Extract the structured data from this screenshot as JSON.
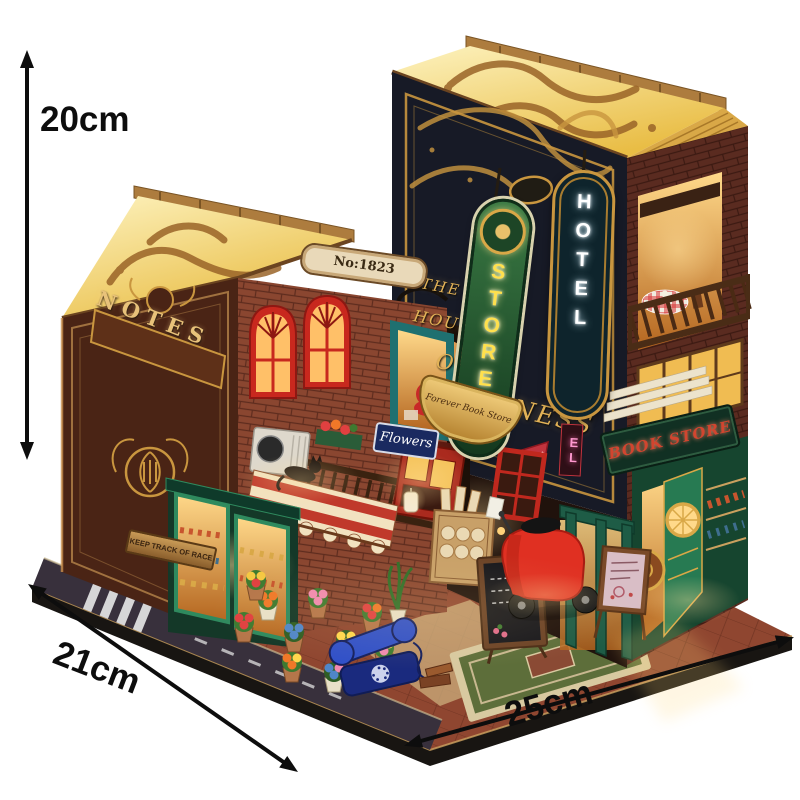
{
  "scene": {
    "subject": "DIY miniature book nook dollhouse product photo",
    "background": "#ffffff"
  },
  "dimensions": {
    "height": "20cm",
    "depth": "21cm",
    "width": "25cm",
    "arrow_color": "#0d0d0d"
  },
  "left_book": {
    "spine_title": "NOTES",
    "address_plaque": "No:1823",
    "flower_shop_sign": "Flowers",
    "hanging_board": "KEEP TRACK OF RACE"
  },
  "right_book": {
    "cover_title_line1": "THE",
    "cover_title_line2": "HOUSE",
    "cover_title_line3": "OF",
    "cover_title_line4": "HAPPINESS",
    "neon_store": "STORE",
    "neon_hotel": "HOTEL",
    "neon_fragment": "EL",
    "banner_script": "Forever Book Store",
    "bookstore_sign": "BOOK STORE"
  },
  "colors": {
    "gold": "#c9963f",
    "warm_glow": "#ffd98a",
    "brick": "#8a4630",
    "cover_navy": "#171a26",
    "store_green": "#2f7a3e",
    "neon_yellow": "#ffe04d",
    "hotel_teal": "#0e242c",
    "scooter_red": "#e03022",
    "door_teal": "#1f7070",
    "platform_terracotta": "#8f4630",
    "awning_red": "#c0392b",
    "awning_cream": "#f2e2c0",
    "phone_blue": "#2840b0"
  }
}
